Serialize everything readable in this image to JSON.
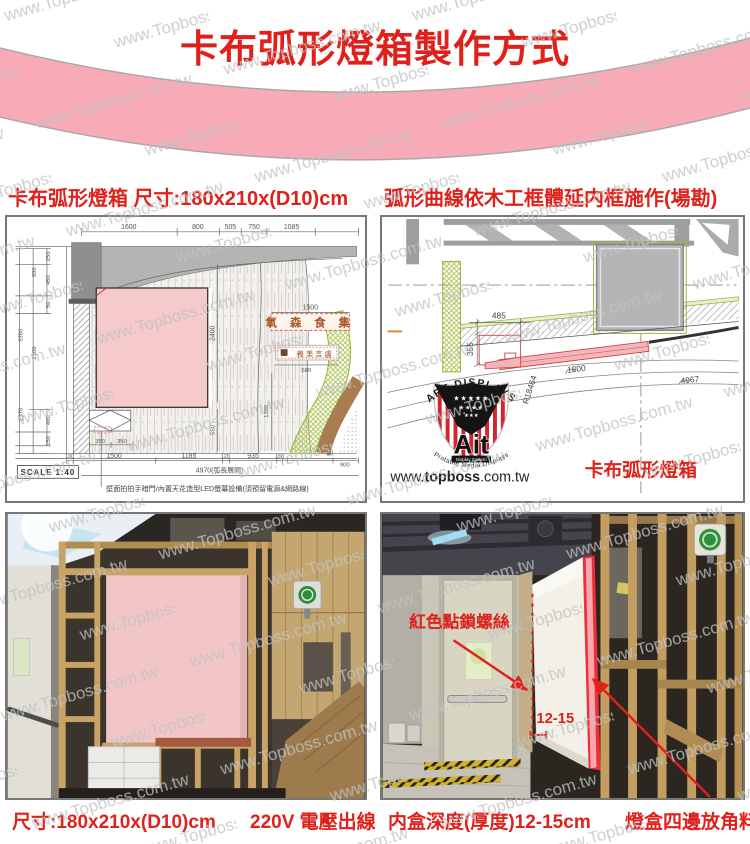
{
  "watermark": {
    "text": "www.Topboss.com.tw"
  },
  "header": {
    "title": "卡布弧形燈箱製作方式"
  },
  "section_labels": {
    "left": "卡布弧形燈箱  尺寸:180x210x(D10)cm",
    "right": "弧形曲線依木工框體延内框施作(場勘)"
  },
  "drawing1": {
    "dims_top": [
      "1600",
      "800",
      "505",
      "750",
      "1085"
    ],
    "dims_left": [
      "250",
      "930",
      "450",
      "50",
      "3350",
      "2100",
      "2370",
      "400",
      "150"
    ],
    "dims_mid": {
      "sign_width": "1500",
      "sign2_width": "580",
      "box_height": "2400",
      "right_height": "1380",
      "under_height": "550"
    },
    "dims_bottom_pair": [
      "350",
      "350"
    ],
    "dims_bottom": [
      "100",
      "1500",
      "1185",
      "120",
      "935",
      "150",
      "80",
      "900"
    ],
    "arc_total": "4970(弧長展開)",
    "scale": "SCALE 1:40",
    "sign_main": "氧 森 食 集",
    "sign_sub": "義美言盧",
    "note": "壁面拍拍手暗門/內置天花造型LED螢幕設備(須預留電源&網路線)"
  },
  "drawing2": {
    "dims": {
      "width": "485",
      "depth": "355",
      "radius": "R18464",
      "arc_inner": "1800",
      "arc_outer": "4967"
    },
    "logo": {
      "arc_top": "ART DISPLAYS",
      "stars_row1": "★★★★★",
      "stars_row2": "★★★★",
      "stars_row3": "★★★",
      "name": "Ait",
      "badge": "Display System",
      "arc_bottom": "Protable Media Displays"
    },
    "website_prefix": "www.",
    "website_bold": "topboss",
    "website_suffix": ".com.tw",
    "label": "卡布弧形燈箱"
  },
  "photo_right": {
    "screw_note": "紅色點鎖螺絲",
    "depth_note": "12-15"
  },
  "captions": {
    "size": "尺寸:180x210x(D10)cm",
    "power": "220V 電壓出線",
    "depth": "内盒深度(厚度)12-15cm",
    "corner": "燈盒四邊放角料"
  },
  "colors": {
    "accent_red": "#e0201a",
    "ribbon_pink": "#f8abb6",
    "lightbox_pink": "#f5c6c8",
    "cad_green": "#9ab33a",
    "highlight_red": "#ef2f3c",
    "watermark_gray": "#c2c2c2"
  }
}
